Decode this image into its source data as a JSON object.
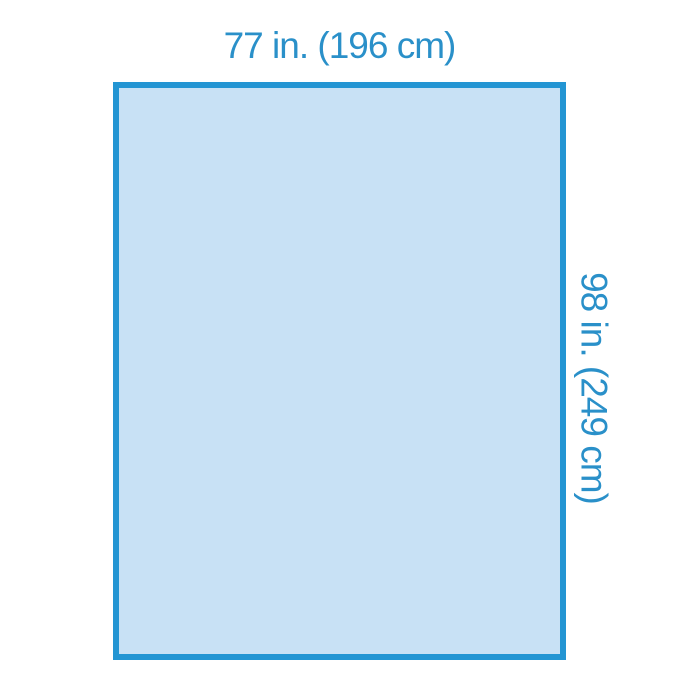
{
  "page": {
    "background": "#ffffff"
  },
  "diagram": {
    "shape": "rectangle",
    "width_label": "77 in. (196 cm)",
    "height_label": "98 in. (249 cm)",
    "colors": {
      "outline": "#2395d3",
      "fill": "#c8e1f5",
      "label": "#2a90c9",
      "bg": "#ffffff"
    }
  }
}
